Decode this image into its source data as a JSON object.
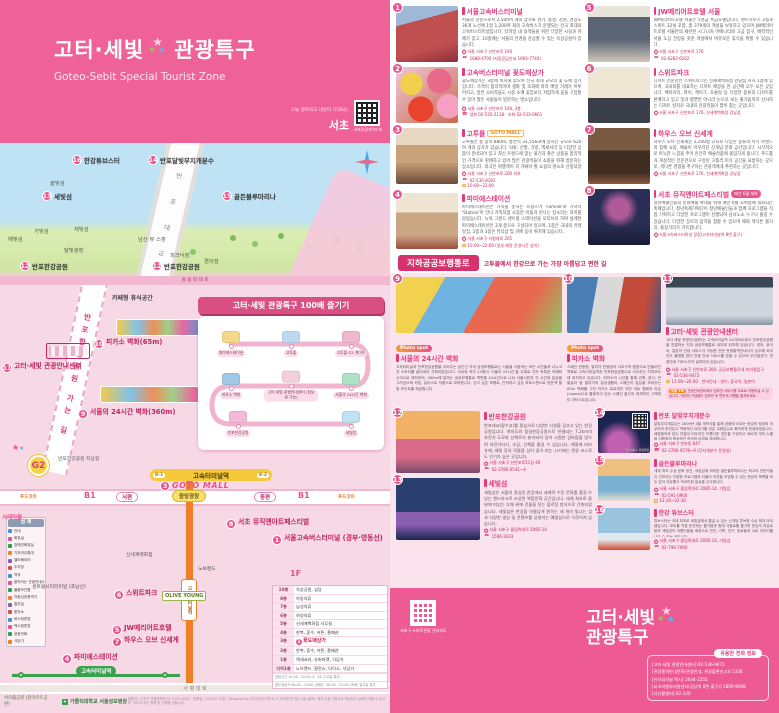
{
  "header": {
    "title1": "고터·세빛",
    "title2": "관광특구",
    "subtitle": "Goteo-Sebit Special Tourist Zone",
    "seocho_tagline": "오늘 행복하고 내일이 기대되는",
    "seocho": "서초",
    "qr_caption": "서초관광가이드북"
  },
  "illus_map": {
    "bridge_label": "반 포 대 교",
    "road_label": "올 림 픽 대 로",
    "labels": [
      {
        "n": "16",
        "t": "한강튜브스터",
        "x": 72,
        "y": 12
      },
      {
        "n": "14",
        "t": "반포달빛무지개분수",
        "x": 148,
        "y": 12
      },
      {
        "n": "15",
        "t": "골든블루마리나",
        "x": 222,
        "y": 48
      },
      {
        "n": "13",
        "t": "세빛섬",
        "x": 42,
        "y": 48
      },
      {
        "t": "솔빛섬",
        "x": 50,
        "y": 36,
        "s": 1
      },
      {
        "t": "가빛섬",
        "x": 34,
        "y": 84,
        "s": 1
      },
      {
        "t": "채빛섬",
        "x": 74,
        "y": 82,
        "s": 1
      },
      {
        "t": "예빛섬",
        "x": 8,
        "y": 92,
        "s": 1
      },
      {
        "t": "달빛광장",
        "x": 64,
        "y": 103,
        "s": 1
      },
      {
        "t": "남산 뷰 스팟",
        "x": 138,
        "y": 92,
        "s": 1
      },
      {
        "t": "피크닉장",
        "x": 170,
        "y": 108,
        "s": 1
      },
      {
        "t": "편의점",
        "x": 204,
        "y": 114,
        "s": 1
      },
      {
        "n": "12",
        "t": "반포한강공원",
        "x": 20,
        "y": 118
      },
      {
        "n": "12",
        "t": "반포한강공원",
        "x": 152,
        "y": 118
      }
    ]
  },
  "street_map": {
    "path_label": "반포한강공원 가는 길",
    "g2": "G2",
    "station": "고속터미널역",
    "exit1": "8-1",
    "exit2": "8-2",
    "line7_station": "고속터미널역",
    "line3_station": "고속터미널역",
    "road_saphyeong": "사 평 대 로",
    "hospital": "가톨릭대학교 서울성모병원",
    "park": "서리풀공원 (몽마르뜨공원)",
    "note": "발행처 | 서초구 관광정책과 02-2155-6201 · 발행일 | 2025년 11월 · Designed by (주)디자인기획  ※ 이 지도에 표기된 시설 정보는 제작 시점 기준으로 작성되어 실제와 다를 수 있으며, 지도의 무단 복제 및 전재를 금합니다.",
    "course": {
      "title": "고터·세빛 관광특구 100배 즐기기",
      "stops": [
        {
          "t": "파미에스테이션",
          "x": 33,
          "y": 28,
          "c": "#f5d98a"
        },
        {
          "t": "고투몰",
          "x": 93,
          "y": 28,
          "c": "#bcd9f0"
        },
        {
          "t": "고투몰 G2 게이트",
          "x": 153,
          "y": 28,
          "c": "#f0b8cc"
        },
        {
          "t": "피카소 벽화",
          "x": 33,
          "y": 70,
          "c": "#9fc8e8"
        },
        {
          "t": "고터·세빛 관광안내센터 (짐보관 가능)",
          "x": 93,
          "y": 70,
          "c": "#f3cfe0"
        },
        {
          "t": "서울의 24시간 벽화",
          "x": 153,
          "y": 70,
          "c": "#aee0c4"
        },
        {
          "t": "반포한강공원",
          "x": 40,
          "y": 108,
          "c": "#f5b8d6"
        },
        {
          "t": "세빛섬",
          "x": 153,
          "y": 108,
          "c": "#bfe3f2"
        }
      ]
    },
    "legend": {
      "title": "범 례",
      "colors": [
        "#4a90d9",
        "#e8538b",
        "#2e9e4f",
        "#f07f28",
        "#8a5fb0",
        "#d94f4f"
      ],
      "items": [
        "안내",
        "화장실",
        "장애인화장실",
        "기저귀교환대",
        "엘리베이터",
        "주차장",
        "약국",
        "움직이는 관광안내소",
        "물품보관함",
        "자동심장충격기",
        "흡연실",
        "환전소",
        "버스정류장",
        "택시정류장",
        "공중전화",
        "식당가"
      ]
    },
    "floors": {
      "rows": [
        {
          "f": "10층",
          "t": "옥상공원, 성당"
        },
        {
          "f": "8층",
          "t": "아동의류"
        },
        {
          "f": "7층",
          "t": "남성의류"
        },
        {
          "f": "6층",
          "t": "여성의류"
        },
        {
          "f": "5층",
          "t": "신세계백화점 사무실"
        },
        {
          "f": "4층",
          "t": "한복, 혼수, 커튼, 홈패션"
        },
        {
          "f": "3층",
          "t": "꽃도매상가",
          "hl": true,
          "badge": "2"
        },
        {
          "f": "2층",
          "t": "한복, 혼수, 커튼, 홈패션"
        },
        {
          "f": "1층",
          "t": "액세서리, 슈퍼마켓, 식당가"
        },
        {
          "f": "지하1층",
          "t": "노브랜드, 환전소, 다이소, 식당가"
        }
      ],
      "note1": "영업시간 10:30 - 20:00 (1, 4주 수요일 휴무)",
      "note2": "꽃도매상가 00:00 - 13:00 (생화) · 00:00 - 23:00 (조화) 일요일 휴무"
    },
    "pois": [
      {
        "t": "카페형 휴식공간",
        "x": 112,
        "y": 8,
        "cls": "lbl"
      },
      {
        "n": "10",
        "t": "피카소 벽화(65m)",
        "x": 94,
        "y": 54,
        "cls": "mk"
      },
      {
        "n": "11",
        "t": "고터·세빛 관광안내센터",
        "x": 2,
        "y": 78,
        "cls": "mk"
      },
      {
        "n": "9",
        "t": "서울의 24시간 벽화(360m)",
        "x": 78,
        "y": 124,
        "cls": "mk"
      },
      {
        "t": "반포한강공원 지상길",
        "x": 58,
        "y": 172,
        "cls": "lbl-s"
      },
      {
        "t": "서래마을",
        "x": 2,
        "y": 228,
        "cls": "pink-s"
      },
      {
        "t": "푸드코트",
        "x": 20,
        "y": 209,
        "cls": "orange-s"
      },
      {
        "t": "B1",
        "x": 84,
        "y": 206,
        "cls": "b1"
      },
      {
        "t": "서편",
        "x": 116,
        "y": 207,
        "cls": "oval"
      },
      {
        "t": "중앙광장",
        "x": 172,
        "y": 205,
        "cls": "oval-y"
      },
      {
        "t": "동편",
        "x": 254,
        "y": 207,
        "cls": "oval"
      },
      {
        "t": "B1",
        "x": 298,
        "y": 206,
        "cls": "b1"
      },
      {
        "t": "푸드코트",
        "x": 338,
        "y": 209,
        "cls": "orange-s"
      },
      {
        "n": "3",
        "t": "GOTO MALL",
        "x": 160,
        "y": 196,
        "cls": "goto"
      },
      {
        "n": "8",
        "t": "서초 뮤직앤아트페스티벌",
        "x": 226,
        "y": 234,
        "cls": "mk"
      },
      {
        "n": "1",
        "t": "서울고속버스터미널 (경부·영동선)",
        "x": 272,
        "y": 250,
        "cls": "mk"
      },
      {
        "t": "신세계백화점",
        "x": 126,
        "y": 268,
        "cls": "lbl-s"
      },
      {
        "t": "노브랜드",
        "x": 198,
        "y": 282,
        "cls": "lbl-s"
      },
      {
        "t": "1F",
        "x": 290,
        "y": 284,
        "cls": "b1"
      },
      {
        "t": "센트럴시티터미널 (호남선)",
        "x": 32,
        "y": 300,
        "cls": "lbl-s"
      },
      {
        "n": "6",
        "t": "스위트파크",
        "x": 114,
        "y": 305,
        "cls": "mk"
      },
      {
        "t": "OLIVE YOUNG",
        "x": 162,
        "y": 306,
        "cls": "oy"
      },
      {
        "n": "5",
        "t": "JW메리어트호텔",
        "x": 112,
        "y": 340,
        "cls": "mk"
      },
      {
        "n": "7",
        "t": "하우스 오브 신세계",
        "x": 112,
        "y": 352,
        "cls": "mk"
      },
      {
        "n": "4",
        "t": "파미에스테이션",
        "x": 62,
        "y": 369,
        "cls": "mk"
      }
    ]
  },
  "right": {
    "banner": {
      "title": "지하공공보행통로",
      "subtitle": "고투몰에서 한강으로 가는 가장 아름답고 편한 길"
    },
    "items": [
      {
        "n": "1",
        "title": "서울고속버스터미널",
        "photo": "p1",
        "body": "서울의 관문으로서 2,500여 개의 상가와 경기, 충청, 강원, 경상도 36개 노선에 1일 1,200여 회의 고속버스가 운행되는 전국 최대의 고속버스터미널입니다. 터미널 내 승객들을 위한 다양한 시설과 카페가 있고, 10층에는 서울의 전경을 감상할 수 있는 옥상공원이 있습니다.",
        "meta": [
          {
            "ic": "pin",
            "t": "서울 서초구 신반포로 194"
          },
          {
            "ic": "tel",
            "t": "1688-4700 (자동응답안내 1666-7740)"
          }
        ]
      },
      {
        "n": "2",
        "title": "고속버스터미널 꽃도매상가",
        "photo": "p2",
        "body": "꽃도매상가는 3층에 위치해 있으며 전국 최대 규모의 꽃 도매 상가입니다. 가격이 합리적이며 생화 및 조화에 따라 매일 거래가 이루어지고, 일반 소비자들도 시중 소매 꽃집보다 저렴하게 꽃을 구입할 수 있어 많은 사람들이 방문하는 명소입니다.",
        "meta": [
          {
            "ic": "pin",
            "t": "서울 서초구 신반포로 194, 3층"
          },
          {
            "ic": "tel",
            "t": "생화 02-535-2118 · 조화 02-533-0661"
          }
        ]
      },
      {
        "n": "3",
        "title": "고투몰",
        "logo": "GOTO MALL",
        "photo": "p3",
        "body": "고투몰은 총 길이 880m, 총면적 31,556㎡에 달하는 규모로 620여 개의 상가가 있습니다. 의류, 신발, 가방, 액세서리 등 다양한 상품이 준비되어 있고 최신 트렌드에 맞는 물건과 좋은 상품을 합리적인 가격으로 판매하고 있어 많은 관광객들이 쇼핑을 위해 방문하는 장소입니다. 외국인 여행객이 꼭 가봐야 할 쇼핑의 명소로 선정되었습니다.",
        "meta": [
          {
            "ic": "pin",
            "t": "서울 서초구 신반포로 200 지하"
          },
          {
            "ic": "tel",
            "t": "02-535-8182"
          },
          {
            "ic": "clock",
            "t": "10:00~22:00"
          }
        ]
      },
      {
        "n": "4",
        "title": "파미에스테이션",
        "photo": "p4",
        "body": "파미에스테이션은 가족을 뜻하는 프랑스어 'Famille'와 기차역 'Station'이 만나 가족처럼 소중한 이들과 만나는 장소라는 의미를 담았습니다. 뉴욕 그랜드 센트럴 스테이션을 모티브로 하여 설계된 파미에스테이션은 3개 층으로 구성되어 있으며, 1층은 국내외 유명 맛집, 2층과 3층은 뷰티샵 및 카페 등이 위치해 있습니다.",
        "meta": [
          {
            "ic": "pin",
            "t": "서울 서초구 사평대로 205"
          },
          {
            "ic": "clock",
            "t": "10:00~22:00 (일부 매장 운영시간 상이)"
          }
        ]
      },
      {
        "n": "5",
        "title": "JW메리어트호텔 서울",
        "photo": "p5",
        "body": "JW메리어트호텔 서울은 5성급 특급호텔입니다. 펜트하우스 2실과 스위트 32실 포함, 총 379개의 객실을 보유하고 있으며 JW메리어트호텔 서울만의 세련된 시그니처 어메니티와 고급 침구, 매력적인 서울 도심 전망을 갖춘 객실에서 여유로운 휴식을 취할 수 있습니다.",
        "meta": [
          {
            "ic": "pin",
            "t": "서울 서초구 신반포로 176"
          },
          {
            "ic": "tel",
            "t": "02-6282-6262"
          }
        ]
      },
      {
        "n": "6",
        "title": "스위트파크",
        "photo": "p6",
        "body": "디저트 전문관인 스위트파크는 신세계백화점 강남점 지하 1층에 있으며, 국내외를 대표하는 디저트 매장을 한 공간에 모두 모은 곳입니다. 베이커리, 파이, 케이크, 초콜릿 등 다양한 종류의 디저트를 판매하고 있고 맛과 향뿐만 아니라 눈으로 보는 즐거움까지 선사하는 디저트 성지로 국내외 관광객들이 많이 찾는 곳입니다.",
        "meta": [
          {
            "ic": "pin",
            "t": "서울 서초구 신반포로 176, 신세계백화점 강남점"
          }
        ]
      },
      {
        "n": "7",
        "title": "하우스 오브 신세계",
        "photo": "p7",
        "body": "하우스 오브 신세계는 2,200평 규모로 다양한 종류의 미식 브랜드와 함께 쇼핑, 예술이 어우러진 신개념 문화 공간입니다. 시각적으로 아늑한 느낌을 주어 온전히 예술작품에 몰입하게 됩니다. 푸드홀과 개성적인 전문관으로 구성된 고품격 미식 공간을 표방하는 곳으로, 색다른 경험을 추구하는 관광객에게 추천하는 곳입니다.",
        "meta": [
          {
            "ic": "pin",
            "t": "서울 서초구 신반포로 176, 신세계백화점 강남점"
          }
        ]
      },
      {
        "n": "8",
        "title": "서초 뮤직앤아트페스티벌",
        "badge": "매년 6월 개최",
        "photo": "p8",
        "body": "청년예술인들의 문화예술 확대를 위해 매년 6월 초여름에 개최되는 축제입니다. 청년축제기획단이 청년예술인들과 함께 프로그램을 직접 기획하고 다양한 프로그램이 진행되며 남녀노소 누구나 즐길 수 있습니다. 다양한 장르의 음악을 접할 수 있으며 매회 색다른 볼거리, 즐길거리가 가득합니다.",
        "meta": [
          {
            "ic": "pin",
            "t": "서울고속버스터미널 광장(고속터미널역 8번 출구)"
          }
        ]
      },
      {
        "n": "9",
        "title": "서울의 24시간 벽화",
        "tag": "Photo spot",
        "photo": "p9",
        "body": "고속터미널과 반포한강공원을 이어주는 공간인 지하 공공보행통로는 서울을 사랑하는 모든 시민들과 나누고자 스토리를 끌어내어 기획되었습니다. 국내외 작가 24명이 '서울의 24시간'을 주제로 각자 독특한 색채와 시각으로 제작하여, 360m에 달하는 공공보행통로 벽면을 24시간으로 나눠 서울시민의 각 시간대 일상을 그려냈으며 카툰, 일러스트 작품으로 보여줍니다. 걷고 싶은 보행로, 간직하고 싶은 포토스팟으로 방문객 힐링 포인트를 제공합니다."
      },
      {
        "n": "10",
        "title": "피카소 벽화",
        "tag": "Photo spot",
        "photo": "p10",
        "body": "스페인 관광청, 말라가 관광청과 서초구의 협업으로 만들어진 벽화로 고속터미널역과 반포한강공원으로 이어지는 지하보도에 위치하고 있습니다. 피카소의 시선을 통해 건축, 음식, 전통놀이 등 말라가의 일상생활과 스페인의 일상을 보여주는 65m 벽화를 그린 작가는 유로피안 어반 아트 협회의 라온(Laone)으로 활동하고 있는 스페인 출신의 세계적인 그래피티 아티스트입니다."
      },
      {
        "n": "11",
        "title": "고터·세빛 관광안내센터",
        "photo": "p11",
        "body": "고터·세빛 관광안내센터는 고속터미널역 G2게이트에서 반포한강공원을 연결하는 지하 공공보행통로 내부에 위치해 있습니다. 영어, 중국어, 일본어 안내 서비스가 가능한 전문 관광통역안내사가 상주해 외국인도 불편함 없이 관광 안내 서비스를 받을 수 있으며 무인발권기, 관광안내 키오스크가 설치되어 있습니다.",
        "meta": [
          {
            "ic": "pin",
            "t": "서울 서초구 신반포로 300, 공공보행통로내 지하철입구"
          },
          {
            "ic": "tel",
            "t": "02-536-9472"
          },
          {
            "ic": "clock",
            "t": "11:00~20:00 · 언어안내 : 영어, 중국어, 일본어"
          }
        ],
        "notice": {
          "tag": "이용 TIP",
          "text": "관광안내센터에서 짐보관 서비스를 무료로 이용하실 수 있습니다. 캐리어·기념품도 짐보관 후 편하게 여행을 즐겨보세요."
        }
      },
      {
        "n": "12",
        "title": "반포한강공원",
        "photo": "p12",
        "body": "반포대교(잠수교)를 중심으로 다양한 시설을 갖추고 있는 한강공원입니다. 여의도와 잠실한강공원으로 연결되는 7.2km의 자전거 도로와 산책로가 분리되어 있어 시원한 강바람을 맞으며 자전거타기, 조깅, 산책을 즐길 수 있습니다. 계절에 따라 유채, 메밀 등의 작물을 심어 꽃이 피는 시기에는 관광 코스로도 인기가 높은 곳입니다.",
        "meta": [
          {
            "ic": "pin",
            "t": "서울 서초구 신반포로11길 40"
          },
          {
            "ic": "tel",
            "t": "02-3780-0541~4"
          }
        ]
      },
      {
        "n": "13",
        "title": "세빛섬",
        "photo": "p13",
        "body": "세빛섬은 서울의 중심인 한강에서 세계적 수준 문화를 즐길 수 있는 랜드마크로 조성된 복합문화 공간입니다. 세계 최초로 물 위에 떠있는 부체 위에 건물을 짓는 플로팅 방식으로 건축되었습니다. 세빛섬은 한강을 아름답게 밝히는 세 개의 빛나는 섬과 다양한 영상 및 콘텐츠를 상영하는 예빛섬으로 이루어져 있습니다.",
        "meta": [
          {
            "ic": "pin",
            "t": "서울 서초구 올림픽대로 2085-14"
          },
          {
            "ic": "tel",
            "t": "1566-3433"
          }
        ]
      },
      {
        "n": "14",
        "title": "반포 달빛무지개분수",
        "photo": "p14",
        "qr": "무지개분수 운영일정",
        "body": "달빛무지개분수는 2009년 4월 개막식을 통해 공중에 오르는 한강의 정취와 어우러져 운치있고 역동적인 이야기를 담은 교량분수로 화려하게 탄생하였습니다. 배경음악과 분수 연출이 어우러진 아름다운 경관을 구성하고 380여 개의 노즐을 이용하여 환상적인 한강의 야경을 제공합니다.",
        "meta": [
          {
            "ic": "pin",
            "t": "서울 서초구 반포동 647"
          },
          {
            "ic": "tel",
            "t": "02-3780-0578~9 (무지개분수 운영실)"
          }
        ]
      },
      {
        "n": "15",
        "title": "골든블루마리나",
        "photo": "p15",
        "body": "세계 최초 수상 문화 공간, 세빛섬에 위치한 골든블루마리나는 최고의 전문가들이 선보이는 다양한 프로그램과 더불어 자연을 조망할 수 있는 한강의 북쪽을 모두 담아 여유롭고 럭셔리한 일상을 선사합니다.",
        "meta": [
          {
            "ic": "pin",
            "t": "서울 서초구 올림픽대로 2085-14, 가빛섬"
          },
          {
            "ic": "tel",
            "t": "02-591-0900"
          },
          {
            "ic": "clock",
            "t": "13:30~22:30"
          }
        ]
      },
      {
        "n": "16",
        "title": "한강 튜브스터",
        "photo": "p16",
        "body": "튜브스터는 국내 최초로 세빛섬에서 즐길 수 있는 신개념 튜브형 수상 레저 아이템입니다. 보트를 직접 운전하는 즐거움과 함께 식음료를 즐기며 한강의 여유로움과 세빛섬의 아름다움을 배경으로 연인, 가족, 친구, 동료들과 서로 이야기를 나눌 수 있는 곳입니다.",
        "meta": [
          {
            "ic": "pin",
            "t": "서울 서초구 올림픽대로 2085-14, 가빛섬"
          },
          {
            "ic": "tel",
            "t": "02-790-7090"
          }
        ]
      }
    ],
    "footer": {
      "qr_caption": "서초구 스마트관광 전자지도",
      "logo1": "고터·세빛",
      "logo2": "관광특구",
      "phone_title": "유용한 전화 정보",
      "phones": [
        [
          "고터·세빛 관광안내센터",
          "02-536-9472"
        ],
        [
          "관광통역안내전화(관광안내, 관광불편신고)",
          "1330"
        ],
        [
          "인터내셔널 택시",
          "1644-2255"
        ],
        [
          "서초여행자지원센터(강남역 8번 출구)",
          "1800-9008"
        ],
        [
          "다산콜센터",
          "02-120"
        ]
      ]
    }
  }
}
